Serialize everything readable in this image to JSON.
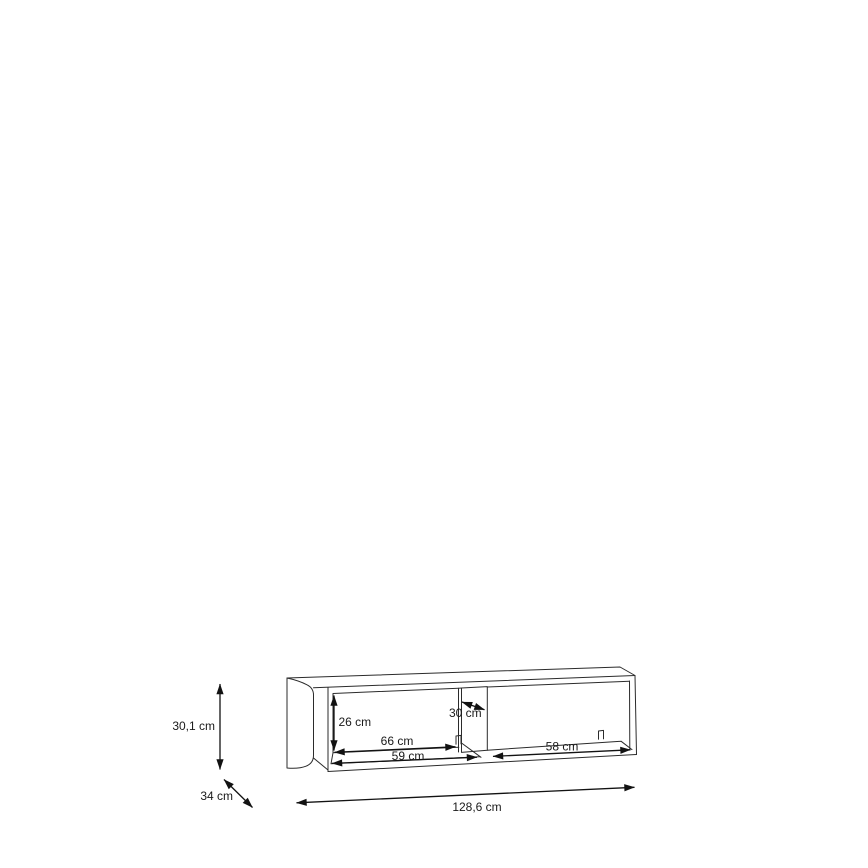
{
  "colors": {
    "background": "#ffffff",
    "wireframe_line": "#2b2b2b",
    "dimension_line": "#121212",
    "label_text": "#1a1a1a"
  },
  "unit": "cm",
  "dimensions": {
    "height": "30,1 cm",
    "depth": "34 cm",
    "width": "128,6 cm",
    "compartment_height": "26 cm",
    "left_compartment_back_width": "66 cm",
    "left_compartment_front_width": "59 cm",
    "divider_depth": "30 cm",
    "right_compartment_width": "58 cm"
  }
}
